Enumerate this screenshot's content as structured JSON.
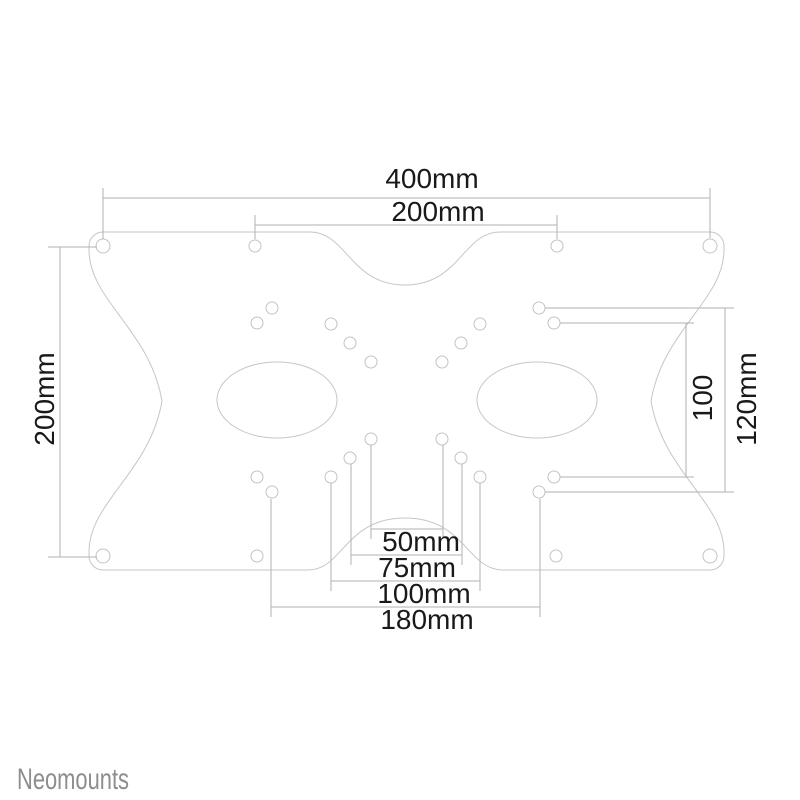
{
  "diagram": {
    "type": "vesa-adapter-plate-dimension-drawing",
    "dimensions": {
      "top_outer": "400mm",
      "top_inner": "200mm",
      "left": "200mm",
      "right_inner": "100",
      "right_outer": "120mm",
      "bottom_1": "50mm",
      "bottom_2": "75mm",
      "bottom_3": "100mm",
      "bottom_4": "180mm"
    }
  },
  "brand": {
    "name": "Neomounts"
  },
  "colors": {
    "background": "#ffffff",
    "plate_outline": "#c6c6c6",
    "dimension_lines": "#b2b2b2",
    "dimension_text": "#191919",
    "brand_text": "#8d8d8d"
  }
}
